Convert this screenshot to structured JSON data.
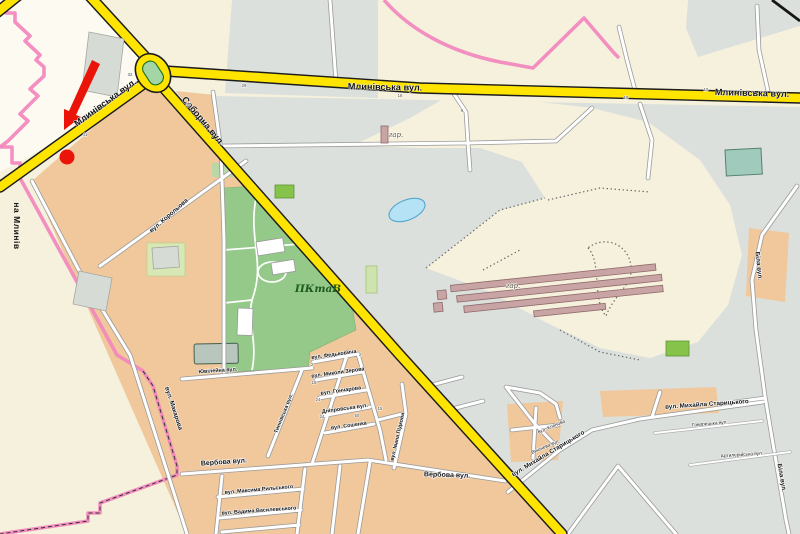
{
  "colors": {
    "road_major": "#ffe400",
    "road_minor": "#ffffff",
    "city_boundary": "#f287bd",
    "built_up_area": "#f0c89b",
    "industrial_area": "#dbe0dc",
    "park_area": "#94c98a",
    "water": "#b5e2f5",
    "marker": "#ea1508"
  },
  "marker": {
    "type": "red-arrow-with-dot",
    "color": "#ea1508"
  },
  "street_labels": [
    {
      "t": "Млинівська вул.",
      "x": 385,
      "y": 90,
      "r": 1,
      "c": "major"
    },
    {
      "t": "Млинівська вул.",
      "x": 752,
      "y": 96,
      "r": 1.5,
      "c": "major"
    },
    {
      "t": "Млинівська вул.",
      "x": 107,
      "y": 105,
      "r": -36,
      "c": "major"
    },
    {
      "t": "Соборна вул.",
      "x": 201,
      "y": 123,
      "r": 50,
      "c": "major"
    },
    {
      "t": "на Млинів",
      "x": 14,
      "y": 226,
      "r": 90,
      "c": "dest"
    },
    {
      "t": "Вербова вул.",
      "x": 224,
      "y": 464,
      "r": -4,
      "c": "minor7"
    },
    {
      "t": "Вербова вул.",
      "x": 447,
      "y": 477,
      "r": 2,
      "c": "minor7"
    },
    {
      "t": "вул. Михайла Старицького",
      "x": 549,
      "y": 455,
      "r": -31,
      "c": "minor65"
    },
    {
      "t": "вул. Михайла Старицького",
      "x": 707,
      "y": 406,
      "r": -4,
      "c": "minor65"
    },
    {
      "t": "вул. Корольова",
      "x": 170,
      "y": 217,
      "r": -41,
      "c": "minor65"
    },
    {
      "t": "вул. Макарова",
      "x": 172,
      "y": 409,
      "r": 72,
      "c": "minor65"
    },
    {
      "t": "Біла вул.",
      "x": 757,
      "y": 266,
      "r": 84,
      "c": "minor65"
    },
    {
      "t": "Біла вул.",
      "x": 780,
      "y": 478,
      "r": 80,
      "c": "minor65"
    },
    {
      "t": "Ювілейна вул.",
      "x": 218,
      "y": 372,
      "r": -4,
      "c": "minor55"
    },
    {
      "t": "вул. Федьковича",
      "x": 334,
      "y": 356,
      "r": -8,
      "c": "minor55"
    },
    {
      "t": "вул. Миколи Зерова",
      "x": 338,
      "y": 374,
      "r": -8,
      "c": "minor55"
    },
    {
      "t": "вул. Гончарова",
      "x": 341,
      "y": 392,
      "r": -8,
      "c": "minor55"
    },
    {
      "t": "Дніпровська вул.",
      "x": 345,
      "y": 410,
      "r": -8,
      "c": "minor55"
    },
    {
      "t": "вул. Сошенка",
      "x": 349,
      "y": 427,
      "r": -8,
      "c": "minor55"
    },
    {
      "t": "вул. Максима Рильського",
      "x": 259,
      "y": 491,
      "r": -5,
      "c": "minor55"
    },
    {
      "t": "вул. Вадима Василевського",
      "x": 259,
      "y": 512,
      "r": -4,
      "c": "minor55"
    },
    {
      "t": "Тиннівська вул.",
      "x": 285,
      "y": 414,
      "r": -68,
      "c": "minor55"
    },
    {
      "t": "вул. Івана Підкови",
      "x": 399,
      "y": 437,
      "r": -77,
      "c": "minor55"
    },
    {
      "t": "Говорецька вул.",
      "x": 710,
      "y": 425,
      "r": -5,
      "c": "minor5"
    },
    {
      "t": "Артилерійська вул.",
      "x": 742,
      "y": 456,
      "r": -4,
      "c": "minor5"
    },
    {
      "t": "вул. Кленова",
      "x": 552,
      "y": 428,
      "r": -23,
      "c": "minor5"
    },
    {
      "t": "Вишнева вул.",
      "x": 546,
      "y": 448,
      "r": -23,
      "c": "minor5"
    },
    {
      "t": "гар.",
      "x": 396,
      "y": 137,
      "r": 0,
      "c": "gartxt"
    },
    {
      "t": "гар.",
      "x": 513,
      "y": 288,
      "r": 0,
      "c": "gartxt"
    },
    {
      "t": "ПКтаВ",
      "x": 318,
      "y": 292,
      "r": 0,
      "c": "parktxt"
    }
  ],
  "house_numbers": [
    {
      "t": "29",
      "x": 244,
      "y": 87
    },
    {
      "t": "44",
      "x": 188,
      "y": 106
    },
    {
      "t": "32",
      "x": 130,
      "y": 76
    },
    {
      "t": "41",
      "x": 85,
      "y": 136
    },
    {
      "t": "9",
      "x": 462,
      "y": 112
    },
    {
      "t": "16",
      "x": 400,
      "y": 97
    },
    {
      "t": "10",
      "x": 706,
      "y": 91
    },
    {
      "t": "18",
      "x": 626,
      "y": 99
    },
    {
      "t": "2",
      "x": 312,
      "y": 366
    },
    {
      "t": "18",
      "x": 314,
      "y": 384
    },
    {
      "t": "24",
      "x": 318,
      "y": 401
    },
    {
      "t": "24",
      "x": 322,
      "y": 418
    },
    {
      "t": "50",
      "x": 357,
      "y": 417
    },
    {
      "t": "15",
      "x": 380,
      "y": 410
    },
    {
      "t": "2",
      "x": 360,
      "y": 356
    }
  ]
}
